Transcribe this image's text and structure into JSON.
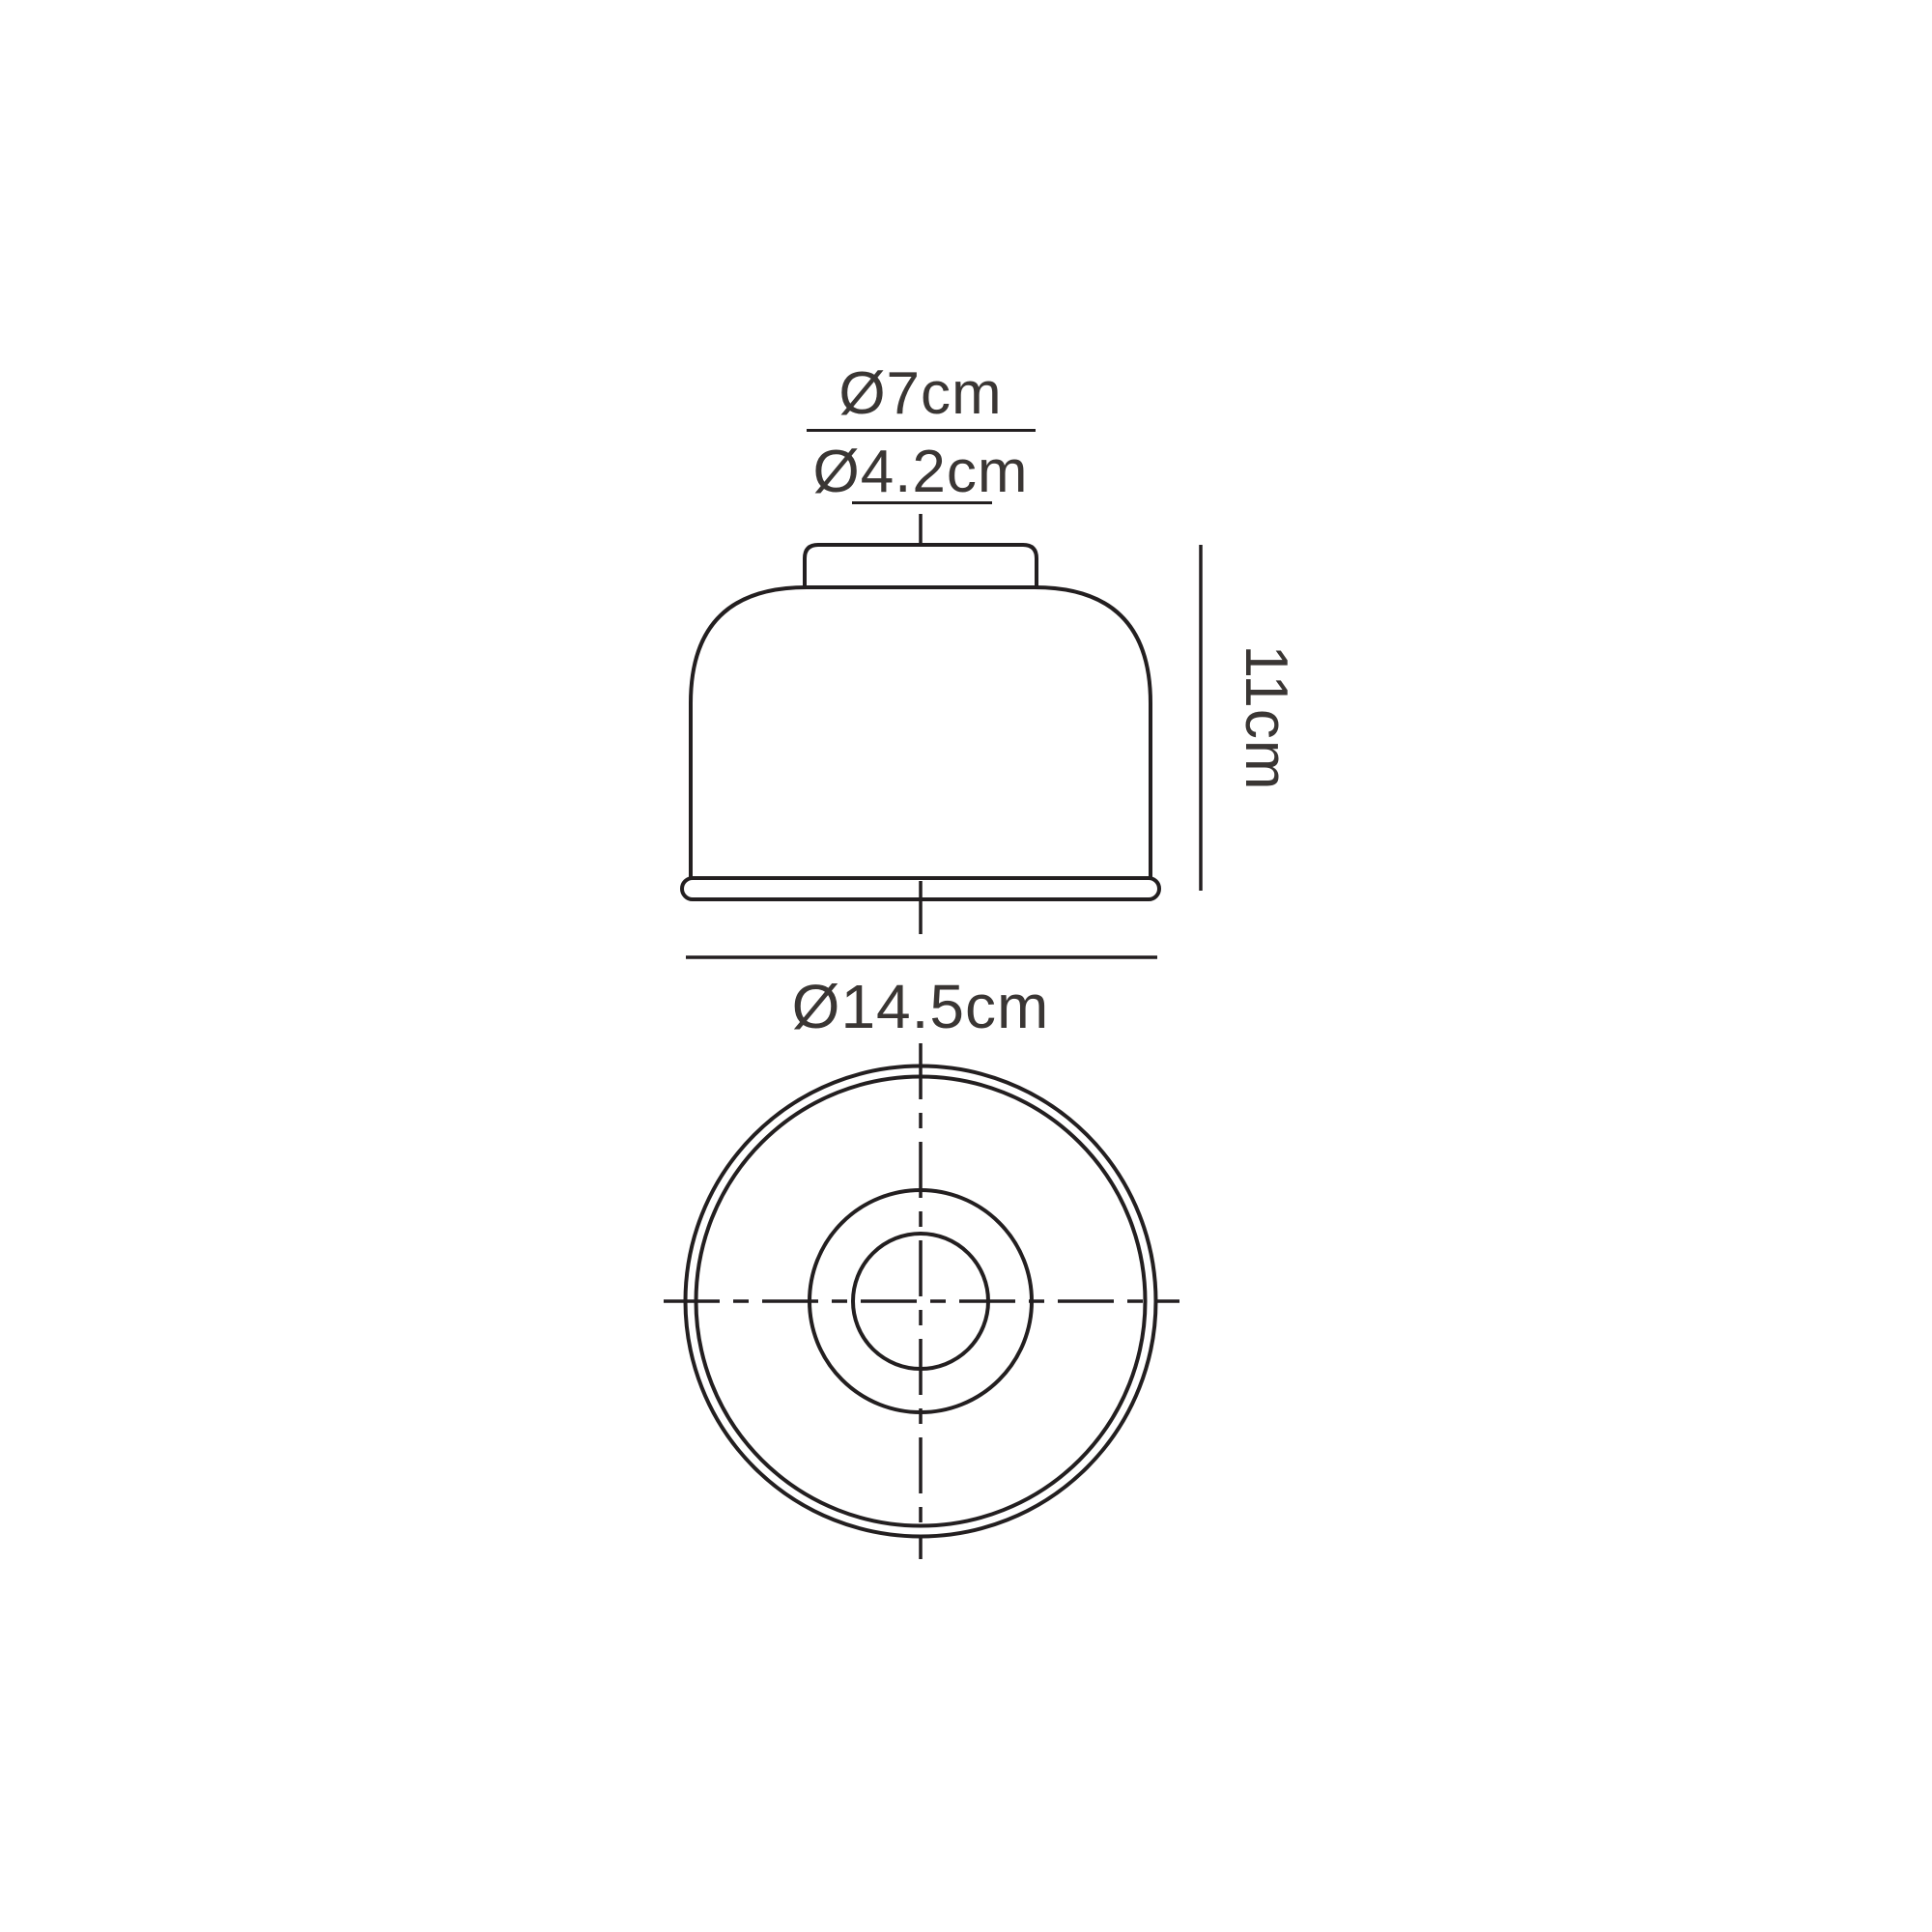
{
  "page": {
    "title": "Lampshade technical dimension drawing",
    "background": "#ffffff",
    "colors": {
      "line": "#231f20",
      "text": "#3a3634",
      "mesh": "#1f1c1b",
      "white": "#ffffff"
    }
  },
  "diagram": {
    "type": "technical-dimension-drawing",
    "subject": "mesh dome shade with neck fitting and base rim",
    "views": [
      {
        "id": "front",
        "name": "front elevation"
      },
      {
        "id": "plan",
        "name": "plan view"
      }
    ],
    "labels": {
      "neck_outer_diameter": "Ø7cm",
      "neck_inner_diameter": "Ø4.2cm",
      "height": "11cm",
      "base_diameter": "Ø14.5cm"
    },
    "dimensions_cm": {
      "neck_outer_diameter": 7,
      "neck_inner_diameter": 4.2,
      "height": 11,
      "base_diameter": 14.5
    }
  }
}
